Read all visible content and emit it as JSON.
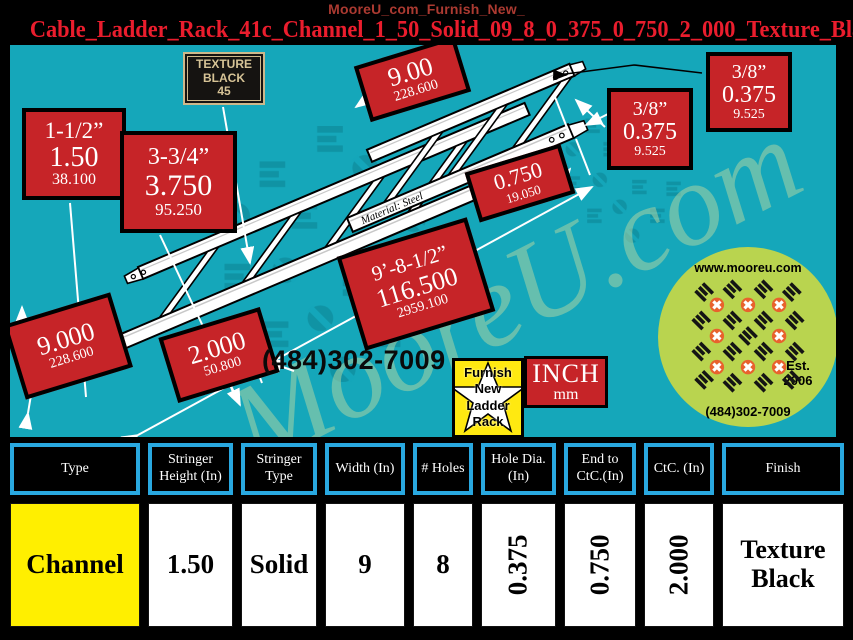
{
  "window": {
    "title": "MooreU_com_Furnish_New_"
  },
  "header": {
    "product_code": "Cable_Ladder_Rack_41c_Channel_1_50_Solid_09_8_0_375_0_750_2_000_Texture_Black"
  },
  "drawing": {
    "texture_plaque": {
      "line1": "TEXTURE",
      "line2": "BLACK",
      "line3": "45"
    },
    "material_note": "Material: Steel",
    "phone": "(484)302-7009",
    "units": {
      "inch": "INCH",
      "mm": "mm"
    },
    "star_badge": {
      "line1": "Furnish",
      "line2": "New",
      "line3": "Ladder",
      "line4": "Rack"
    },
    "logo": {
      "website": "www.mooreu.com",
      "established": "Est.",
      "established_year": "2006",
      "phone": "(484)302-7009"
    },
    "watermark": "MooreU.com",
    "copyright": "2018 ©Copyright - Mooreu.com",
    "labels": {
      "stringer_height": {
        "inch": "1-1/2”",
        "dec": "1.50",
        "mm": "38.100"
      },
      "rail_width": {
        "inch": "3-3/4”",
        "dec": "3.750",
        "mm": "95.250"
      },
      "width_top": {
        "dec": "9.00",
        "mm": "228.600"
      },
      "hole_dia_a": {
        "inch": "3/8”",
        "dec": "0.375",
        "mm": "9.525"
      },
      "hole_dia_b": {
        "inch": "3/8”",
        "dec": "0.375",
        "mm": "9.525"
      },
      "end_to_ctc": {
        "dec": "0.750",
        "mm": "19.050"
      },
      "overall_length": {
        "inch": "9’-8-1/2”",
        "dec": "116.500",
        "mm": "2959.100"
      },
      "width_bottom": {
        "dec": "9.000",
        "mm": "228.600"
      },
      "ctc": {
        "dec": "2.000",
        "mm": "50.800"
      }
    },
    "colors": {
      "canvas_teal": "#15a7ba",
      "label_red": "#c62428",
      "table_border_cyan": "#29a8e0",
      "highlight_yellow": "#ffef00"
    }
  },
  "table": {
    "headers": [
      "Type",
      "Stringer Height (In)",
      "Stringer Type",
      "Width (In)",
      "# Holes",
      "Hole Dia. (In)",
      "End to CtC.(In)",
      "CtC. (In)",
      "Finish"
    ],
    "values": [
      "Channel",
      "1.50",
      "Solid",
      "9",
      "8",
      "0.375",
      "0.750",
      "2.000",
      "Texture Black"
    ]
  }
}
